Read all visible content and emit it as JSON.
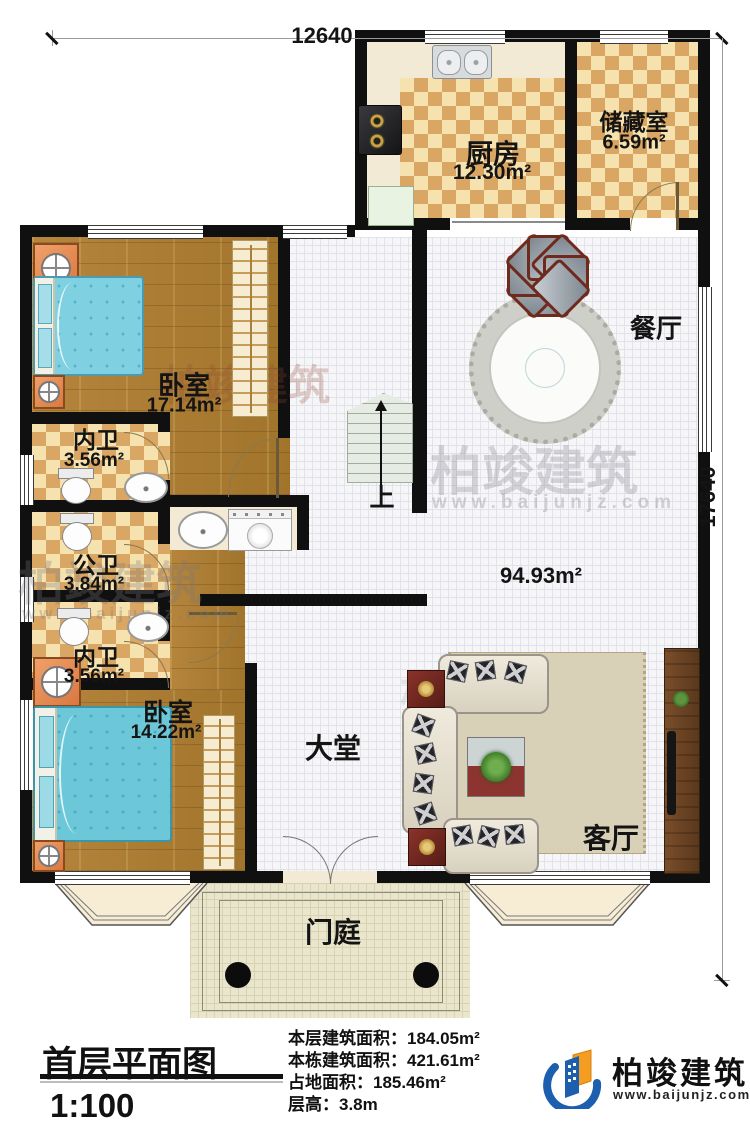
{
  "dimensions": {
    "top": "12640",
    "right": "17640"
  },
  "rooms": {
    "kitchen": {
      "name": "厨房",
      "area": "12.30m²"
    },
    "storage": {
      "name": "储藏室",
      "area": "6.59m²"
    },
    "dining": {
      "name": "餐厅"
    },
    "bedroom1": {
      "name": "卧室",
      "area": "17.14m²"
    },
    "bath1": {
      "name": "内卫",
      "area": "3.56m²"
    },
    "bath2": {
      "name": "公卫",
      "area": "3.84m²"
    },
    "bath3": {
      "name": "内卫",
      "area": "3.56m²"
    },
    "bedroom2": {
      "name": "卧室",
      "area": "14.22m²"
    },
    "hall": {
      "name": "大堂",
      "area": "94.93m²"
    },
    "living": {
      "name": "客厅"
    },
    "porch": {
      "name": "门庭"
    }
  },
  "stairs": {
    "up_label": "上"
  },
  "title_block": {
    "title": "首层平面图",
    "scale": "1:100",
    "info": [
      {
        "label": "本层建筑面积：",
        "value": "184.05m²"
      },
      {
        "label": "本栋建筑面积：",
        "value": "421.61m²"
      },
      {
        "label": "占地面积：",
        "value": "185.46m²"
      },
      {
        "label": "层高：",
        "value": "3.8m"
      }
    ]
  },
  "brand": {
    "name": "柏竣建筑",
    "url": "www.baijunjz.com"
  },
  "watermark": {
    "text": "柏竣建筑",
    "url": "www.baijunjz.com"
  },
  "colors": {
    "wall": "#101010",
    "checker_light": "#f6e2ae",
    "checker_dark": "#d9a763",
    "wood": "#ad7e33",
    "bed_blue": "#7fd0e0",
    "accent_red": "#7a2a22",
    "brand_blue": "#1b5fae",
    "brand_orange": "#f49d20"
  }
}
